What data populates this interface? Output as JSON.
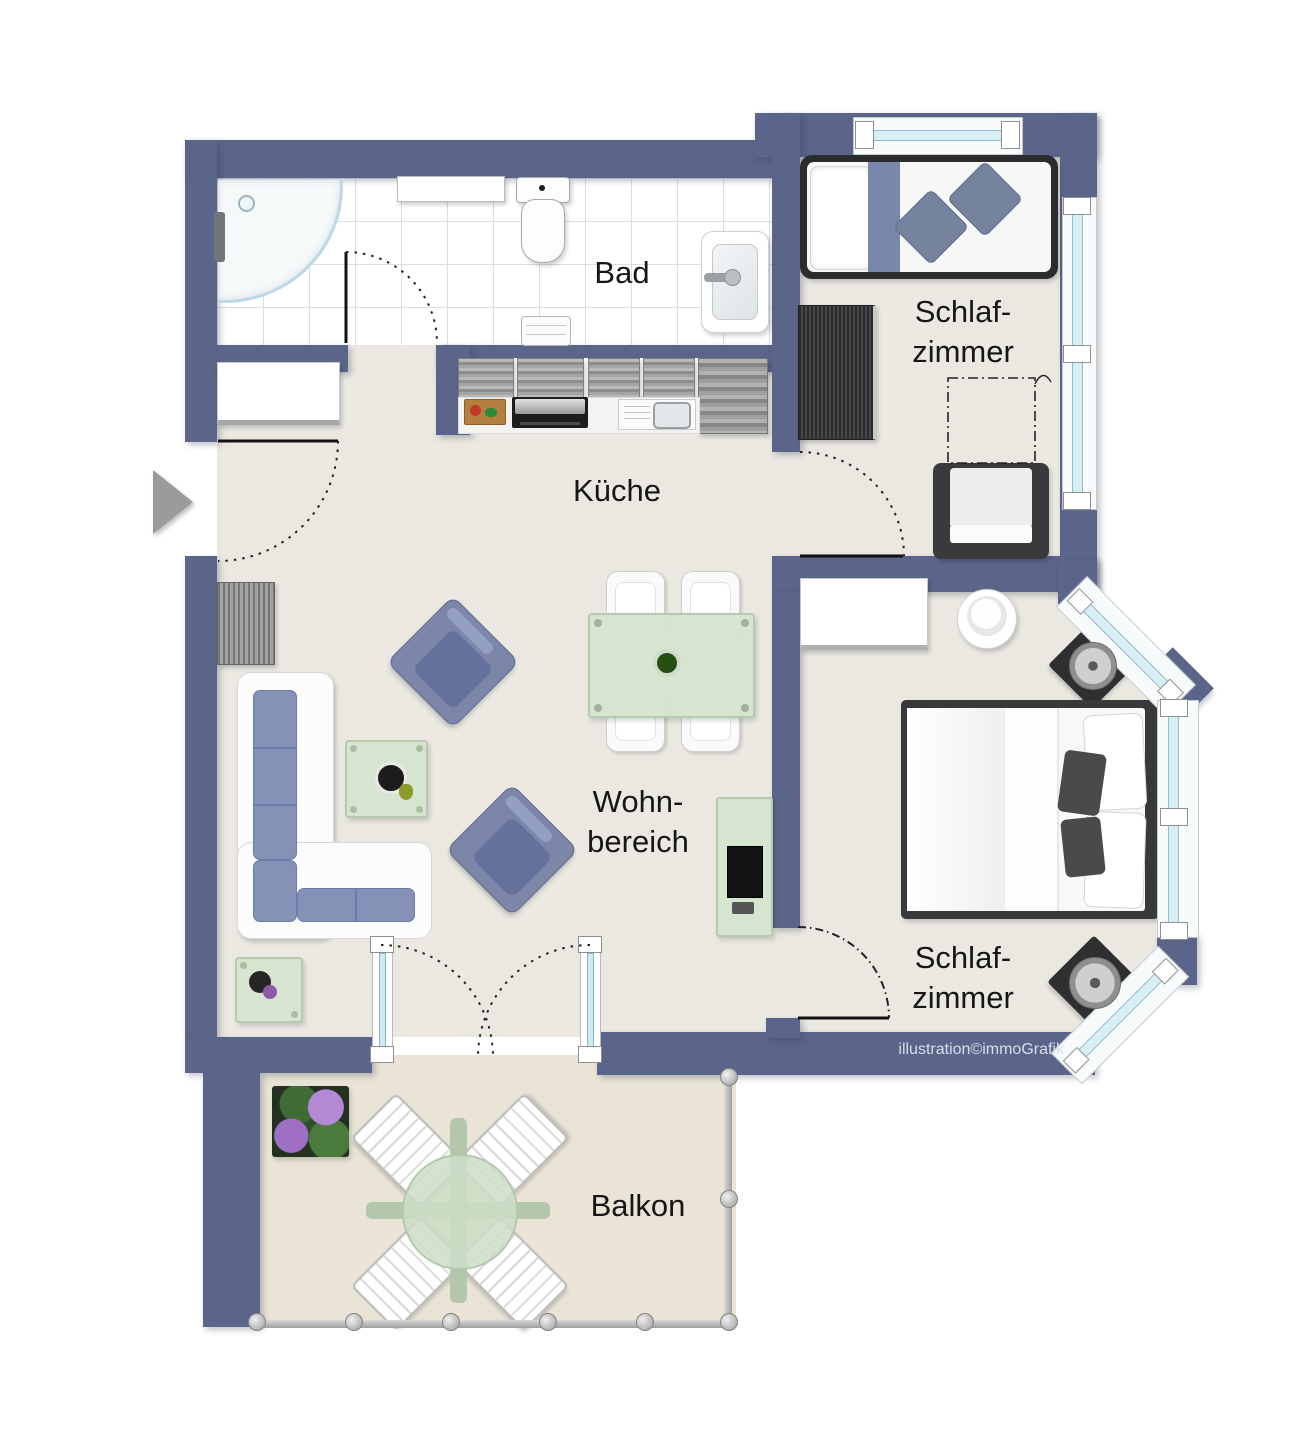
{
  "labels": {
    "bathroom": "Bad",
    "kitchen": "Küche",
    "living_line1": "Wohn-",
    "living_line2": "bereich",
    "bedroom1_line1": "Schlaf-",
    "bedroom1_line2": "zimmer",
    "bedroom2_line1": "Schlaf-",
    "bedroom2_line2": "zimmer",
    "balcony": "Balkon",
    "watermark": "illustration©immoGrafik"
  },
  "colors": {
    "wall": "#5a6589",
    "floor": "#eae8e1",
    "bathroom_floor": "#ffffff",
    "balcony_floor": "#e9e4d6",
    "window_glass": "#d8eef5",
    "furniture_blue": "#7b86a8",
    "glass_table_green": "#d6e4cf",
    "label_text": "#161616",
    "watermark_text": "#d9dde8"
  },
  "rooms": [
    {
      "id": "bad",
      "label": "Bad"
    },
    {
      "id": "kueche",
      "label": "Küche"
    },
    {
      "id": "wohnbereich",
      "label": "Wohn-bereich"
    },
    {
      "id": "schlafzimmer-1",
      "label": "Schlaf-zimmer"
    },
    {
      "id": "schlafzimmer-2",
      "label": "Schlaf-zimmer"
    },
    {
      "id": "balkon",
      "label": "Balkon"
    }
  ]
}
